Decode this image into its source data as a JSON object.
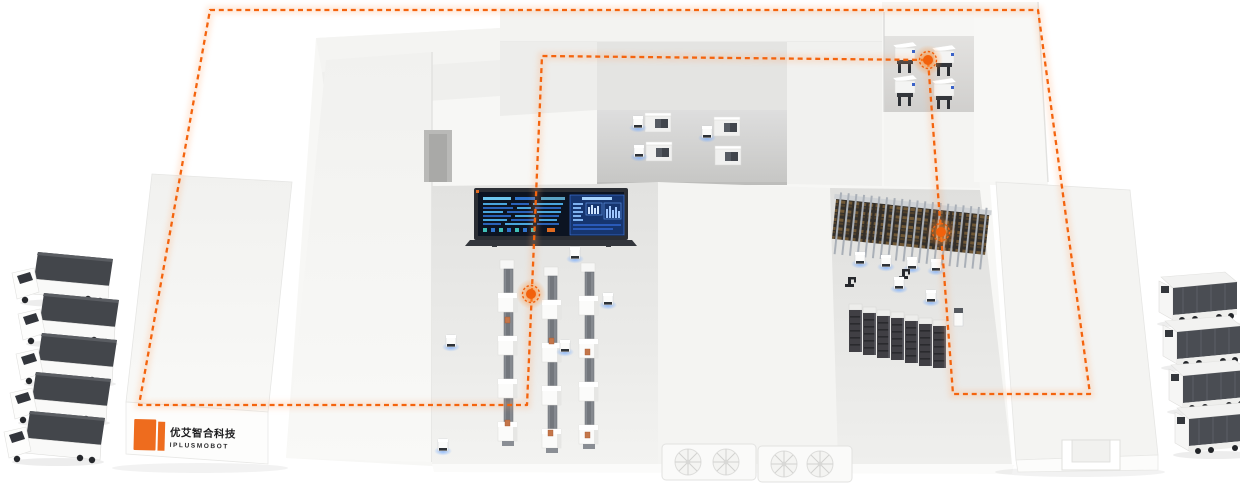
{
  "scene": {
    "description": "Isometric smart-factory logistics illustration: AMR robots, stocker racks, production lines, automated trucks and a glowing dashed AGV route loop"
  },
  "logo": {
    "mark_color": "#ee6c1e",
    "company_cn": "优艾智合科技",
    "company_en": "IPLUSMOBOT"
  },
  "palette": {
    "route_orange": "#f4640e",
    "marker_glow_orange": "#ff7b1f",
    "building_white": "#f6f6f4",
    "floor_gray": "#e7e7e5",
    "mezzanine_gray": "#d6d6d4",
    "rack_dark": "#3c3c40",
    "truck_box_gray": "#4a4d53",
    "dashboard_screen_navy": "#0c1422",
    "dashboard_panel_blue": "#16356f",
    "dashboard_cyan": "#6ec6ee",
    "agv_glow_blue": "#6fa8ff"
  },
  "counts": {
    "left_trucks": 5,
    "right_trucks": 4,
    "production_lines": 3,
    "stocker_rack_rows": 2,
    "buffer_rack_units": 7,
    "alcove_machines": 4,
    "mezzanine_cabinets": 4,
    "route_glow_markers": 3,
    "hvac_fan_units": 2
  }
}
